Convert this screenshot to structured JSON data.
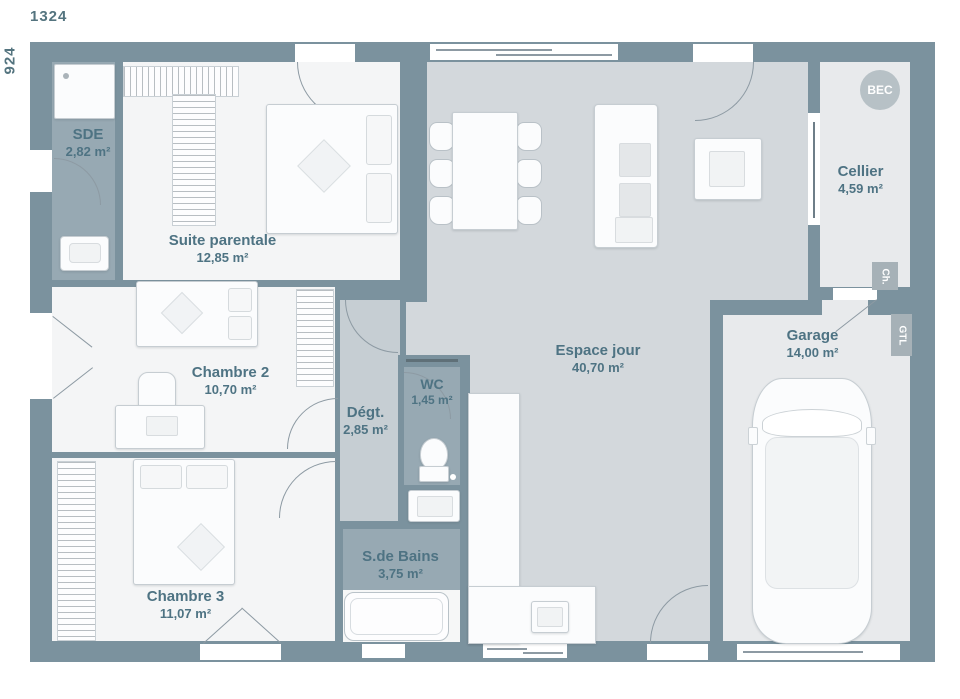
{
  "plan": {
    "dim_top": "1324",
    "dim_left": "924",
    "rooms": [
      {
        "id": "sde",
        "name": "SDE",
        "area": "2,82 m²"
      },
      {
        "id": "suite-parentale",
        "name": "Suite parentale",
        "area": "12,85 m²"
      },
      {
        "id": "chambre-2",
        "name": "Chambre 2",
        "area": "10,70 m²"
      },
      {
        "id": "chambre-3",
        "name": "Chambre 3",
        "area": "11,07 m²"
      },
      {
        "id": "degagement",
        "name": "Dégt.",
        "area": "2,85 m²"
      },
      {
        "id": "wc",
        "name": "WC",
        "area": "1,45 m²"
      },
      {
        "id": "salle-de-bains",
        "name": "S.de Bains",
        "area": "3,75 m²"
      },
      {
        "id": "espace-jour",
        "name": "Espace jour",
        "area": "40,70 m²"
      },
      {
        "id": "cellier",
        "name": "Cellier",
        "area": "4,59 m²"
      },
      {
        "id": "garage",
        "name": "Garage",
        "area": "14,00 m²"
      }
    ],
    "badges": {
      "bec": "BEC",
      "ch": "Ch.",
      "gtl": "GTL"
    },
    "palette": {
      "wall": "#7b929e",
      "bath_floor": "#97a9b3",
      "bedroom_floor": "#f4f5f6",
      "living_floor": "#d3d8dc",
      "hall_floor": "#c6ced3",
      "garage_floor": "#e8eaec",
      "label_text": "#4e7383"
    }
  }
}
